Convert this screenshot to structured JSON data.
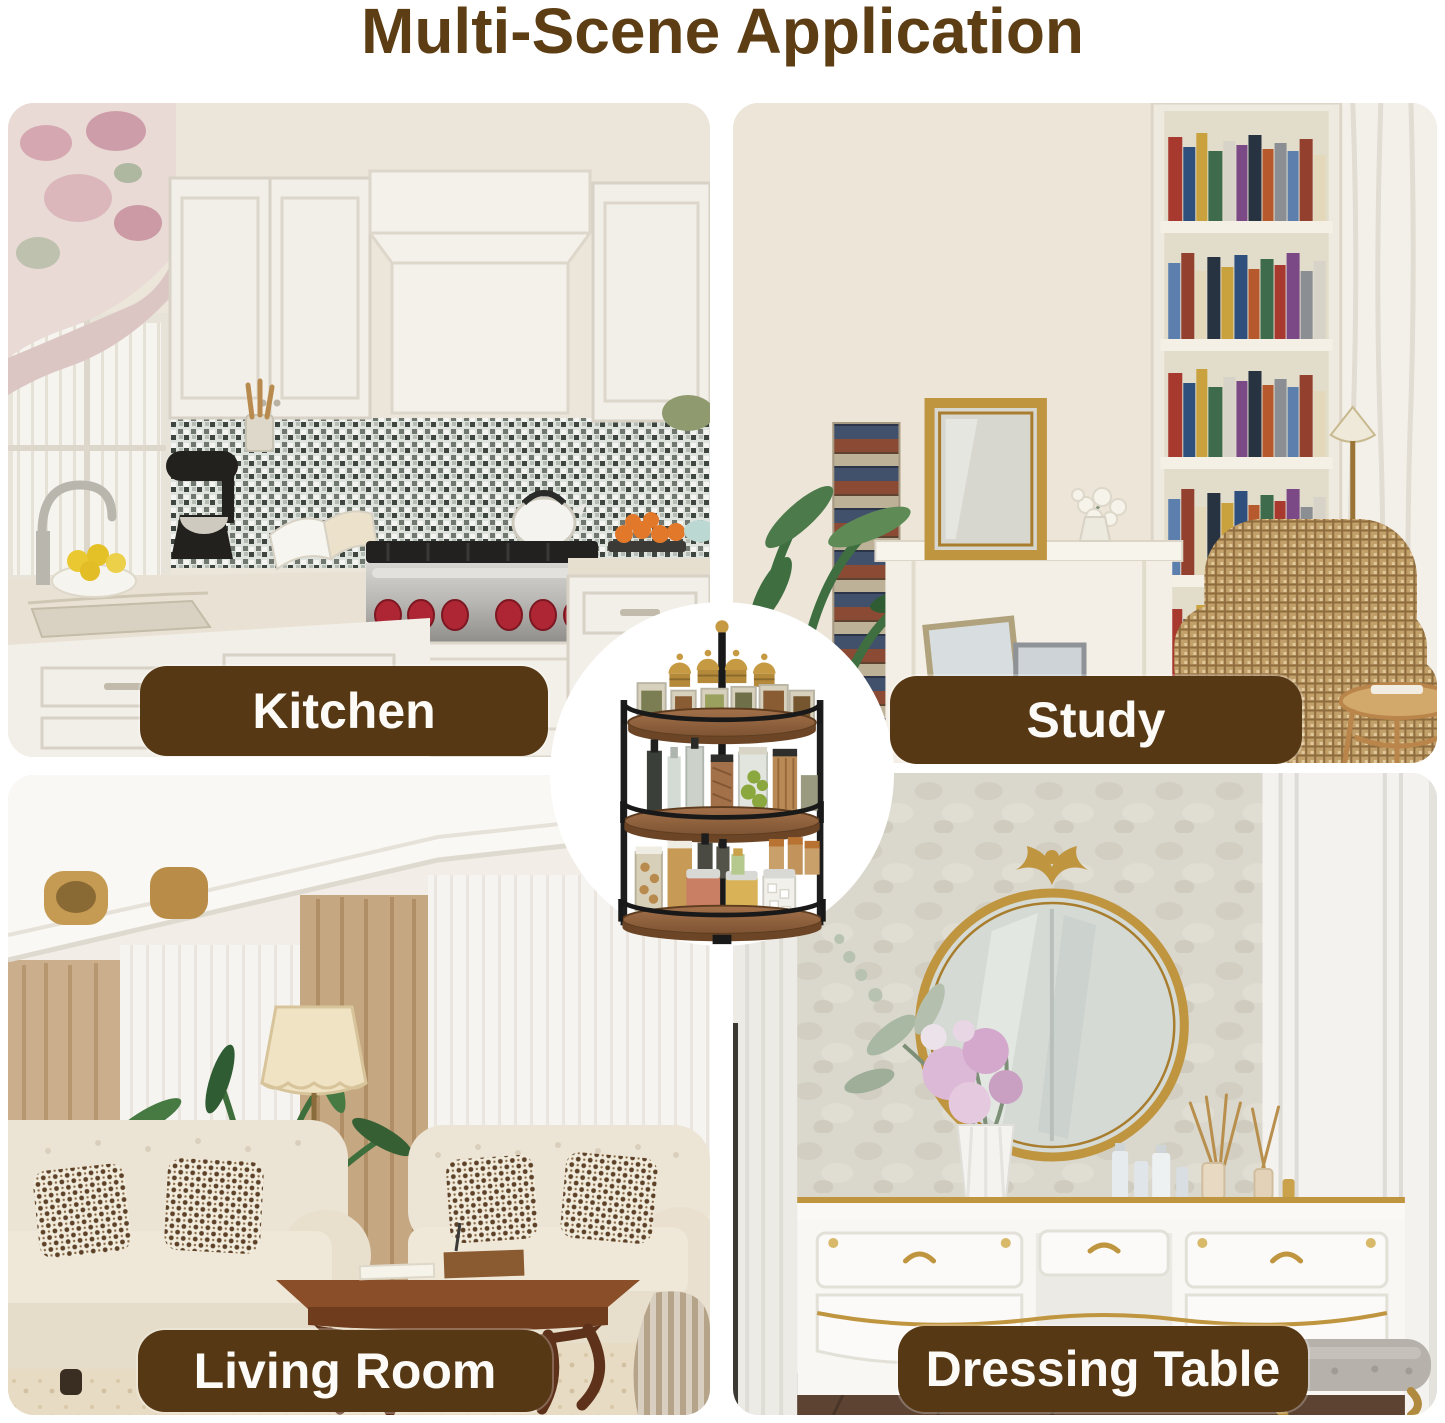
{
  "title": "Multi-Scene Application",
  "colors": {
    "background": "#ffffff",
    "title_text": "#5d3e14",
    "badge_background": "#573814",
    "badge_text": "#fdfbf7"
  },
  "scenes": [
    {
      "id": "kitchen",
      "label": "Kitchen"
    },
    {
      "id": "study",
      "label": "Study"
    },
    {
      "id": "living_room",
      "label": "Living Room"
    },
    {
      "id": "dressing_table",
      "label": "Dressing Table"
    }
  ],
  "center_product": {
    "description": "3-tier rotating spice rack with wood shelves, black metal frame and assorted filled jars"
  }
}
